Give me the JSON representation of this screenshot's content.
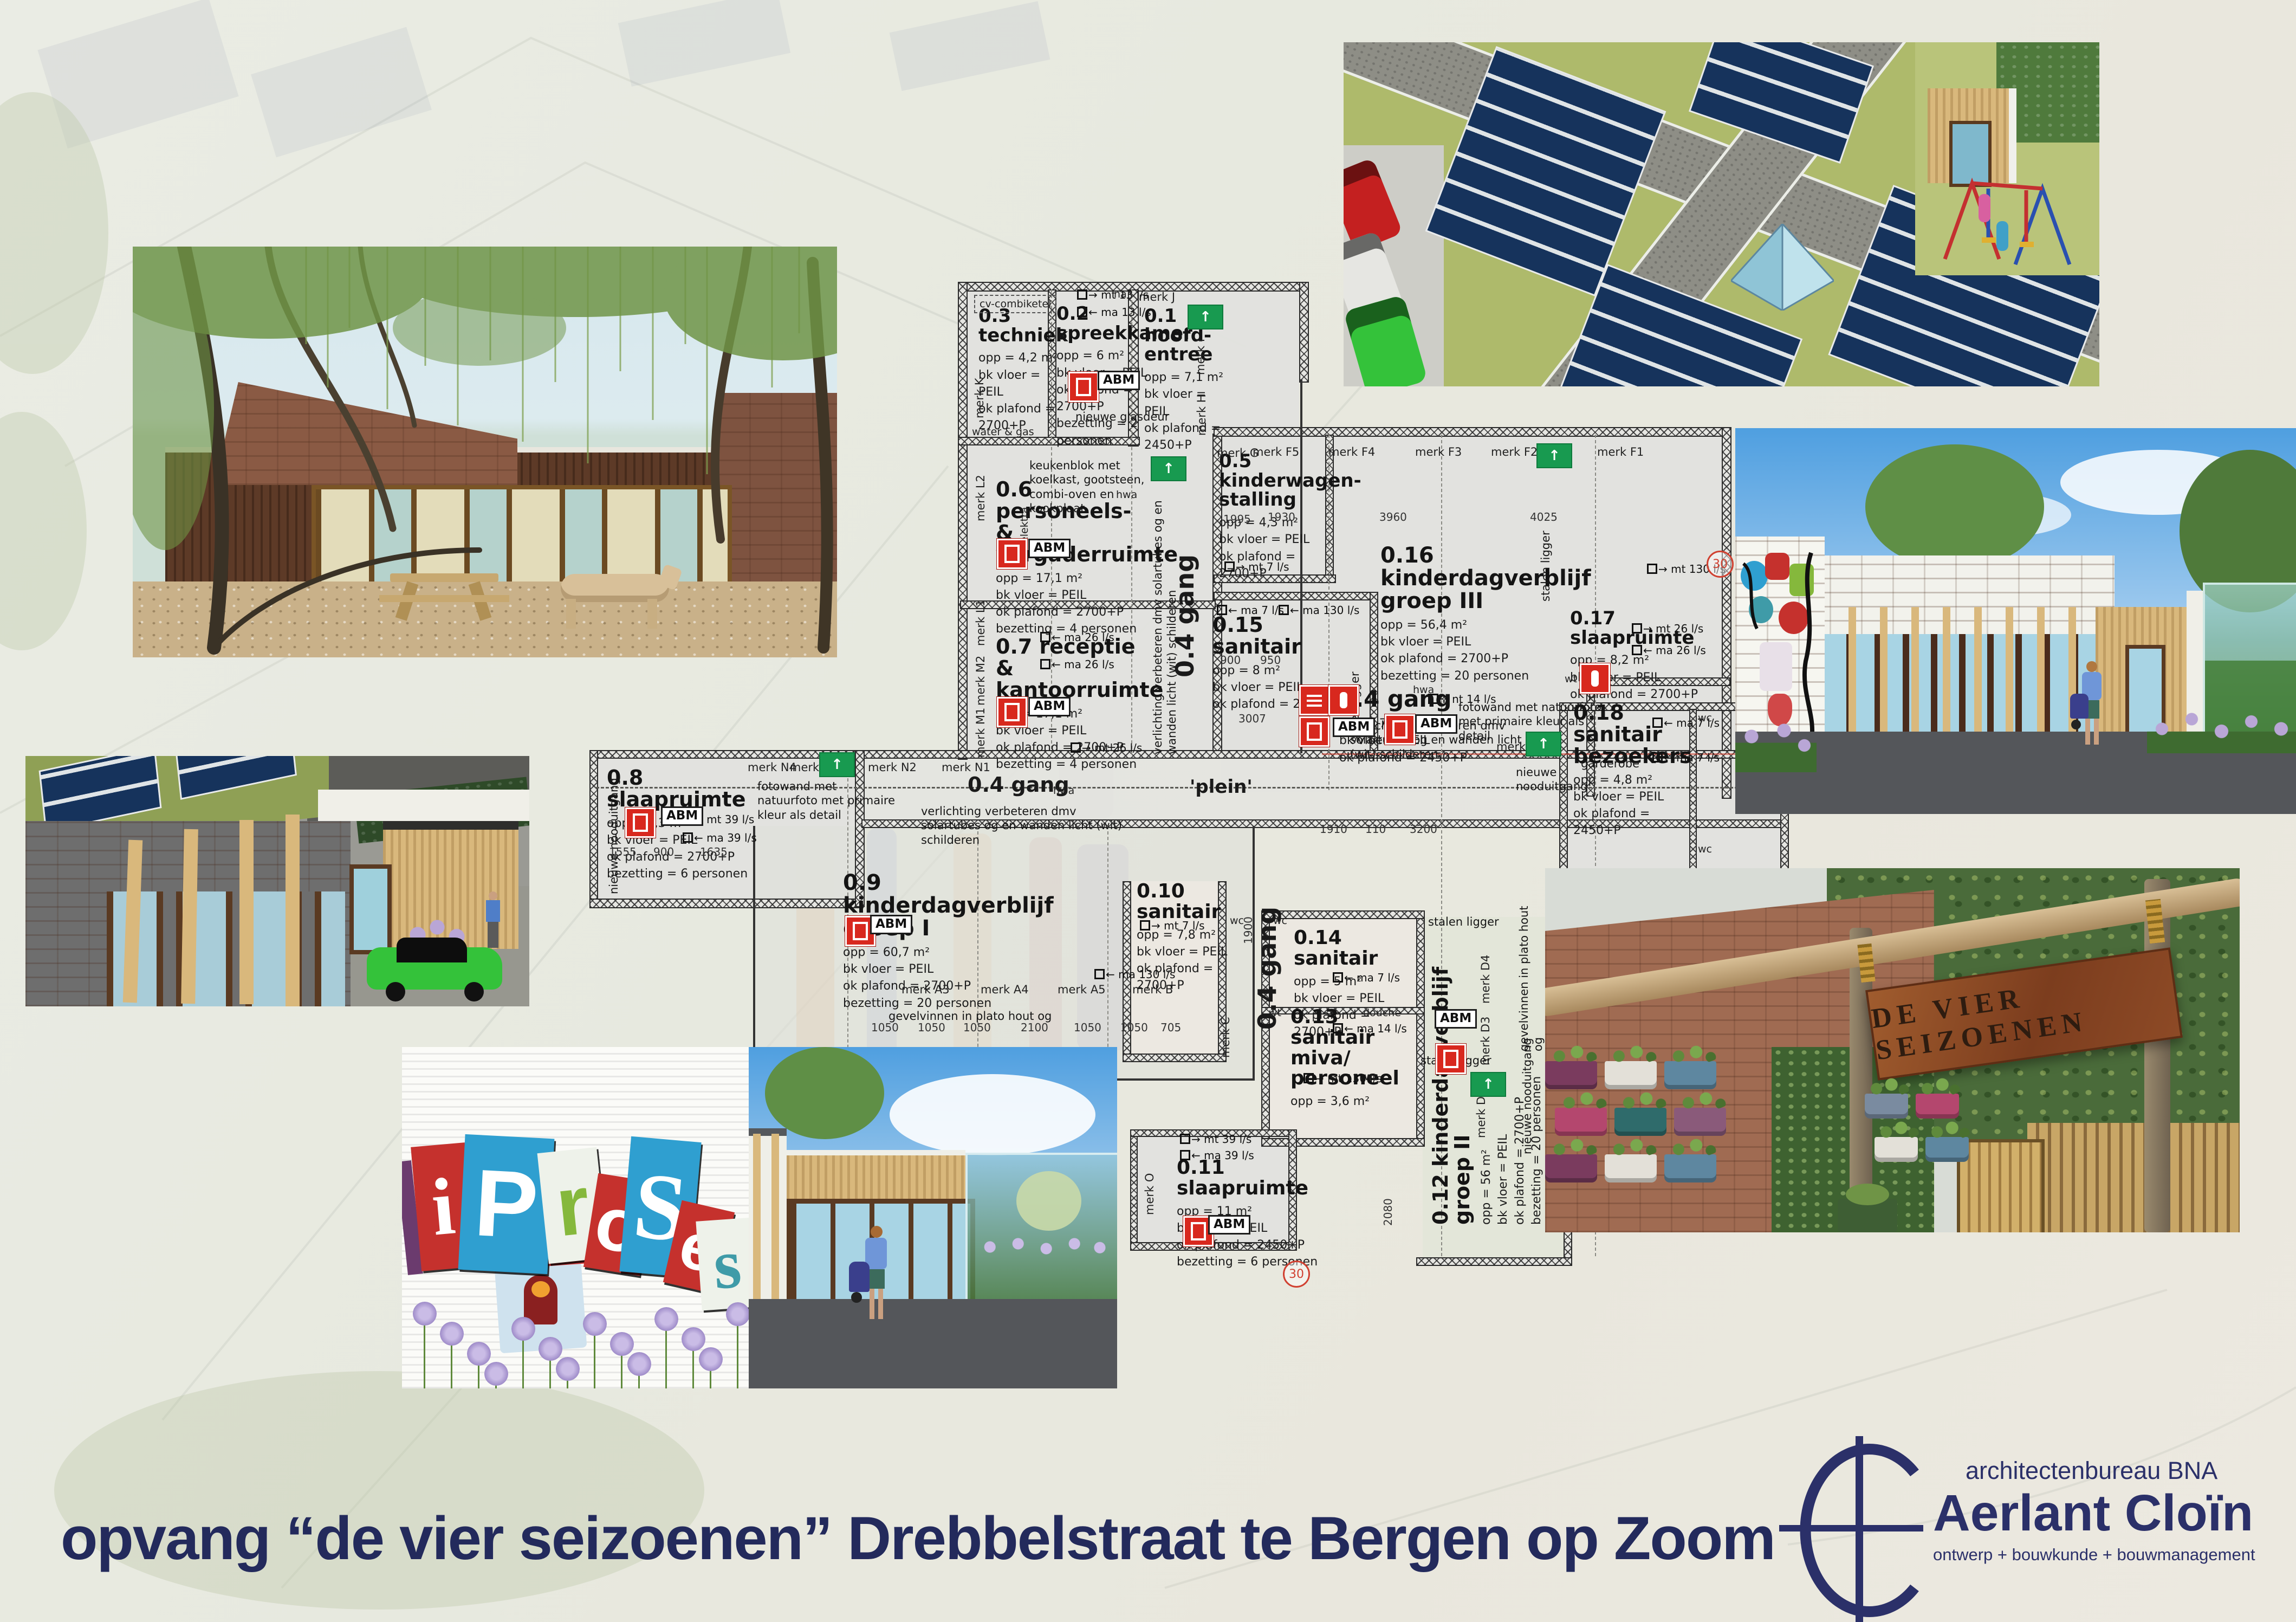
{
  "title": {
    "text": "opvang “de vier seizoenen” Drebbelstraat te Bergen op Zoom"
  },
  "logo": {
    "bureau": "architectenbureau BNA",
    "name": "Aerlant Cloïn",
    "tagline": "ontwerp + bouwkunde + bouwmanagement"
  },
  "sign": {
    "text": "DE VIER SEIZOENEN"
  },
  "mural": {
    "letters": [
      "i",
      "P",
      "r",
      "o",
      "S",
      "e",
      "s"
    ]
  },
  "colors": {
    "accent_navy": "#232a5c",
    "plan_red": "#d8281e",
    "exit_green": "#189a50",
    "roof_green": "#aeba6b",
    "solar_navy": "#16335c",
    "corten": "#8d4f2b",
    "car_green": "#3ec43e"
  },
  "plan": {
    "rooms": [
      {
        "id": "0.3",
        "name": "techniek",
        "specs": [
          "opp = 4,2 m²",
          "bk vloer = PEIL",
          "ok plafond = 2700+P"
        ]
      },
      {
        "id": "0.2",
        "name": "spreekkamer",
        "specs": [
          "opp = 6 m²",
          "bk vloer = PEIL",
          "ok plafond = 2700+P",
          "bezetting = 2 personen"
        ]
      },
      {
        "id": "0.1",
        "name": "hoofd- entree",
        "specs": [
          "opp = 7,1 m²",
          "bk vloer = PEIL",
          "ok plafond = 2450+P"
        ]
      },
      {
        "id": "0.6",
        "name": "personeels- & vergaderruimte",
        "specs": [
          "opp = 17,1 m²",
          "bk vloer = PEIL",
          "ok plafond = 2700+P",
          "bezetting = 4 personen"
        ]
      },
      {
        "id": "0.7",
        "name": "receptie & kantoorruimte",
        "specs": [
          "opp = 17,1 m²",
          "bk vloer = PEIL",
          "ok plafond = 2700+P",
          "bezetting = 4 personen"
        ]
      },
      {
        "id": "0.5",
        "name": "kinderwagen- stalling",
        "specs": [
          "opp = 4,3 m²",
          "bk vloer = PEIL",
          "ok plafond = 2700+P"
        ]
      },
      {
        "id": "0.16",
        "name": "kinderdagverblijf groep III",
        "specs": [
          "opp = 56,4 m²",
          "bk vloer = PEIL",
          "ok plafond = 2700+P",
          "bezetting = 20 personen"
        ]
      },
      {
        "id": "0.15",
        "name": "sanitair",
        "specs": [
          "opp = 8 m²",
          "bk vloer = PEIL",
          "ok plafond = 2700+P"
        ]
      },
      {
        "id": "0.17",
        "name": "slaapruimte",
        "specs": [
          "opp = 8,2 m²",
          "bk vloer = PEIL",
          "ok plafond = 2700+P"
        ]
      },
      {
        "id": "0.18",
        "name": "sanitair bezoekers",
        "specs": [
          "opp = 4,8 m²",
          "bk vloer = PEIL",
          "ok plafond = 2450+P"
        ]
      },
      {
        "id": "0.4",
        "name": "gang",
        "specs": [
          "opp = 72,1 m²",
          "bk vloer = PEIL",
          "ok plafond = 2450+P"
        ]
      },
      {
        "id": "0.8",
        "name": "slaapruimte",
        "specs": [
          "opp = 8,3 m²",
          "bk vloer = PEIL",
          "ok plafond = 2700+P",
          "bezetting = 6 personen"
        ]
      },
      {
        "id": "0.9",
        "name": "kinderdagverblijf groep I",
        "specs": [
          "opp = 60,7 m²",
          "bk vloer = PEIL",
          "ok plafond = 2700+P",
          "bezetting = 20 personen"
        ]
      },
      {
        "id": "0.10",
        "name": "sanitair",
        "specs": [
          "opp = 7,8 m²",
          "bk vloer = PEIL",
          "ok plafond = 2700+P"
        ]
      },
      {
        "id": "0.14",
        "name": "sanitair",
        "specs": [
          "opp = 5 m²",
          "bk vloer = PEIL",
          "ok plafond = 2700+P"
        ]
      },
      {
        "id": "0.13",
        "name": "sanitair miva/ personeel",
        "specs": [
          "opp = 3,6 m²"
        ]
      },
      {
        "id": "0.12",
        "name": "kinderdagverblijf groep II",
        "specs": [
          "opp = 56 m²",
          "bk vloer = PEIL",
          "ok plafond = 2700+P",
          "bezetting = 20 personen"
        ]
      },
      {
        "id": "0.11",
        "name": "slaapruimte",
        "specs": [
          "opp = 11 m²",
          "bk vloer = PEIL",
          "ok plafond = 2450+P",
          "bezetting = 6 personen"
        ]
      }
    ],
    "corridor_labels": [
      "0.4 gang",
      "0.4 gang",
      "0.4 gang",
      "'plein'"
    ],
    "notes": [
      "keukenblok met koelkast, gootsteen, combi-oven en kookplaat",
      "nieuwe glasdeur",
      "fotowand met natuurfoto met primaire kleur als detail",
      "verlichting verbeteren dmv solartubes og en wanden licht (wit) schilderen",
      "fotowand met natuurfoto met primaire kleur als detail",
      "verlichting verbeteren dmv solartubes og en wanden licht (wit) schilderen",
      "nieuwe nooduitgang",
      "nieuwe nooduitgang",
      "gevelvinnen in plato hout og",
      "gevelvinnen in plato hout og",
      "nieuwe nooduitgang",
      "stalen ligger",
      "stalen ligger",
      "stalen ligger",
      "stalen ligger",
      "garderobe",
      "verlichting verbeteren dmv solartubes og en wanden licht (wit) schilderen"
    ],
    "marks": [
      "merk J",
      "merk K",
      "merk I",
      "merk H",
      "merk L2",
      "merk L1",
      "merk M2",
      "merk M1",
      "merk G",
      "merk F5",
      "merk F4",
      "merk F3",
      "merk F2",
      "merk F1",
      "merk N4",
      "merk N3",
      "merk N2",
      "merk N1",
      "merk A3",
      "merk A4",
      "merk A5",
      "merk B",
      "merk C",
      "merk D4",
      "merk D3",
      "merk D2",
      "merk E",
      "merk O"
    ],
    "vents": [
      "mt 13 l/s",
      "ma 13 l/s",
      "ma 26 l/s",
      "ma 26 l/s",
      "mt 26 l/s",
      "mt 7 l/s",
      "ma 7 l/s",
      "ma 130 l/s",
      "mt 130 l/s",
      "mt 26 l/s",
      "ma 26 l/s",
      "ma 7 l/s",
      "ma 7 l/s",
      "nt 14 l/s",
      "mt 39 l/s",
      "ma 39 l/s",
      "mt 39 l/s",
      "ma 39 l/s",
      "ma 130 l/s",
      "mt 7 l/s",
      "ma 7 l/s",
      "ma 14 l/s",
      "mt 130 l/s"
    ],
    "small_labels": [
      "cv-combiketel",
      "water & gas",
      "elektra",
      "hwa",
      "hwa",
      "hwa",
      "wt",
      "wc",
      "wc",
      "wc",
      "wc",
      "wt",
      "douche",
      "wc",
      "na",
      "nt"
    ],
    "dims": [
      "1995",
      "1930",
      "3960",
      "4025",
      "900",
      "950",
      "3007",
      "1555",
      "900",
      "1635",
      "1050",
      "1050",
      "1050",
      "2100",
      "1050",
      "1050",
      "705",
      "1910",
      "110",
      "3200",
      "2080",
      "1900"
    ],
    "badge": "ABM",
    "bubble": "30"
  }
}
